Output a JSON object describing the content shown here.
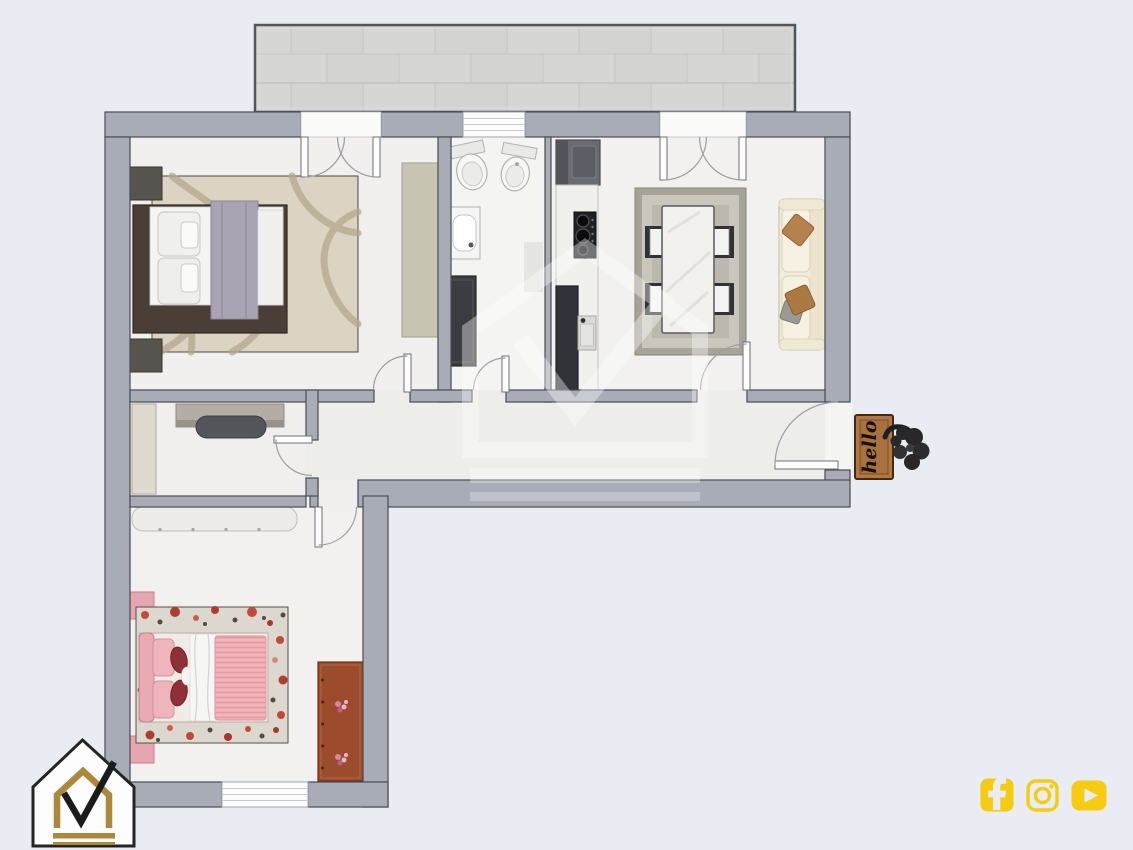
{
  "scene": {
    "type": "top-down 3D apartment floor-plan render"
  },
  "doormat": {
    "text": "hello",
    "color": "#a9713f"
  },
  "branding": {
    "logo": "house-checkmark-logo",
    "watermark": "house-checkmark-watermark",
    "gold": "#ab883c",
    "black": "#1f1f1f"
  },
  "social": {
    "accent": "#f5cc12",
    "icons": [
      {
        "name": "facebook"
      },
      {
        "name": "instagram"
      },
      {
        "name": "youtube"
      }
    ]
  },
  "colors": {
    "background": "#e9ecf2",
    "wall": "#a7acb6",
    "wall_outline": "#4a4b51",
    "floor": "#f1f0ee",
    "balcony_tile": "#d5d5d3"
  },
  "floor_plan": {
    "balcony": {
      "position": "top",
      "finish": "grey-tile"
    },
    "rooms": [
      {
        "name": "bedroom-1",
        "furniture": [
          "double-bed",
          "lavender-throw",
          "swirl-rug",
          "nightstand",
          "nightstand",
          "wardrobe"
        ]
      },
      {
        "name": "bathroom",
        "furniture": [
          "toilet",
          "bidet",
          "washbasin",
          "shower"
        ]
      },
      {
        "name": "kitchen",
        "furniture": [
          "fridge",
          "hob",
          "counter",
          "sink",
          "tall-cabinet"
        ]
      },
      {
        "name": "living-dining",
        "furniture": [
          "dining-table",
          "chair",
          "chair",
          "chair",
          "chair",
          "rug",
          "sofa",
          "cushions"
        ]
      },
      {
        "name": "study",
        "furniture": [
          "desk",
          "chair",
          "cabinet"
        ]
      },
      {
        "name": "hallway",
        "furniture": []
      },
      {
        "name": "bedroom-2",
        "furniture": [
          "double-bed",
          "floral-rug",
          "nightstand",
          "nightstand",
          "wardrobe",
          "dresser"
        ]
      }
    ],
    "entrance": {
      "side": "right",
      "decor": [
        "doormat",
        "plant"
      ]
    }
  }
}
